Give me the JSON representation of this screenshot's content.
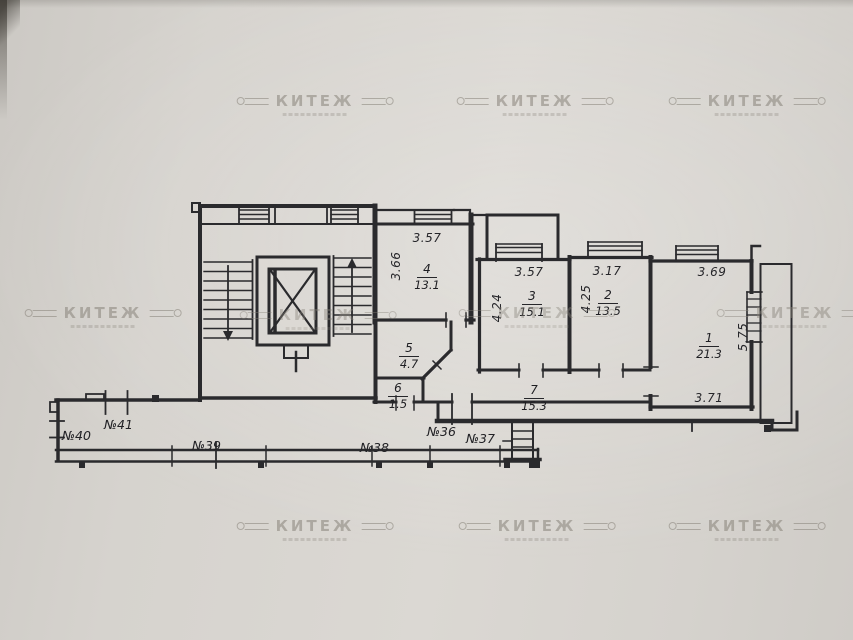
{
  "watermark": {
    "brand": "КИТЕЖ"
  },
  "rooms": {
    "r1": {
      "num": "1",
      "area": "21.3",
      "dim_top": "3.69",
      "dim_side": "5.75",
      "dim_bottom": "3.71"
    },
    "r2": {
      "num": "2",
      "area": "13.5",
      "dim_top": "3.17",
      "dim_side": "4.25"
    },
    "r3": {
      "num": "3",
      "area": "15.1",
      "dim_top": "3.57",
      "dim_side": "4.24"
    },
    "r4": {
      "num": "4",
      "area": "13.1",
      "dim_top": "3.57",
      "dim_side": "3.66"
    },
    "r5": {
      "num": "5",
      "area": "4.7"
    },
    "r6": {
      "num": "6",
      "area": "1.5"
    },
    "r7": {
      "num": "7",
      "area": "15.3"
    }
  },
  "units": {
    "u36": "№36",
    "u37": "№37",
    "u38": "№38",
    "u39": "№39",
    "u40": "№40",
    "u41": "№41"
  }
}
